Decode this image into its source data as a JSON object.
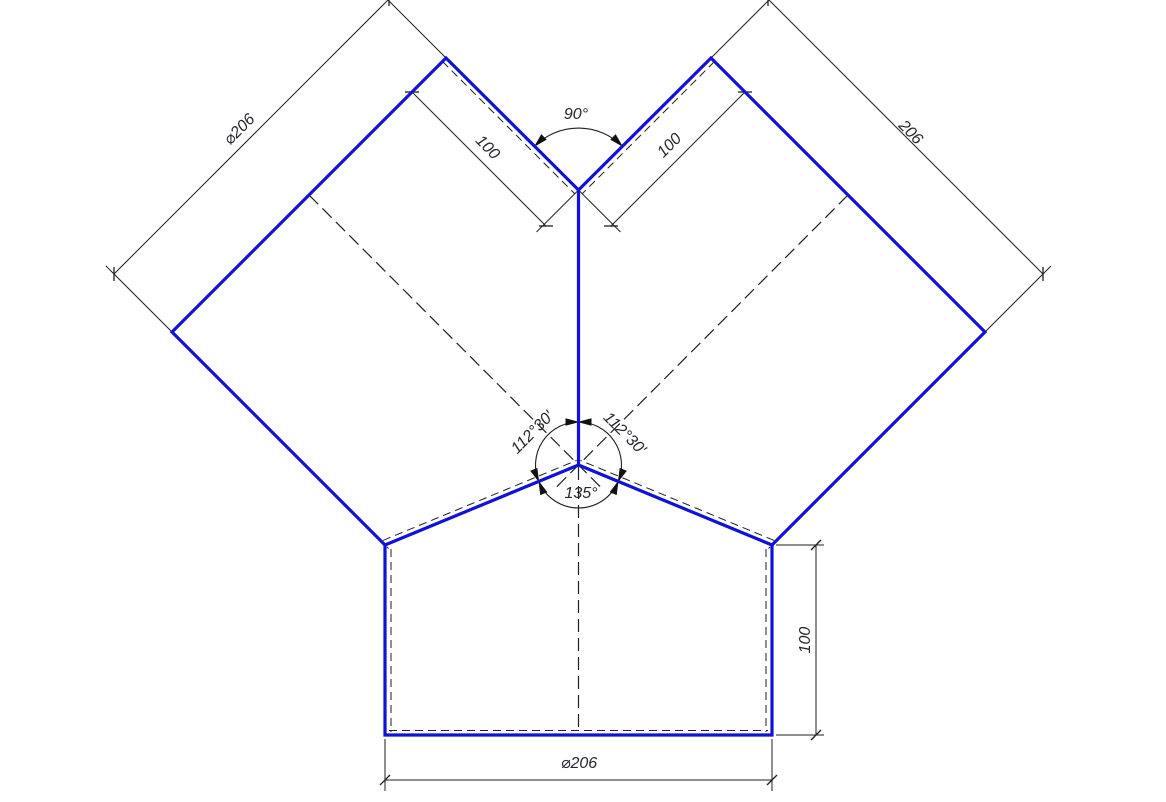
{
  "drawing": {
    "description": "Y-branch pipe fitting dimensioned technical drawing",
    "colors": {
      "background": "#ffffff",
      "outline": "#1111d8",
      "thin": "#1f1f1f",
      "text": "#26262e"
    },
    "labels": {
      "left_cap_diameter": "⌀206",
      "left_branch_width": "100",
      "crotch_angle": "90°",
      "right_branch_width": "100",
      "right_cap_length": "206",
      "left_junction_angle": "112°30′",
      "right_junction_angle": "112°30′",
      "bottom_junction_angle": "135°",
      "outlet_height": "100",
      "outlet_diameter": "⌀206"
    }
  }
}
